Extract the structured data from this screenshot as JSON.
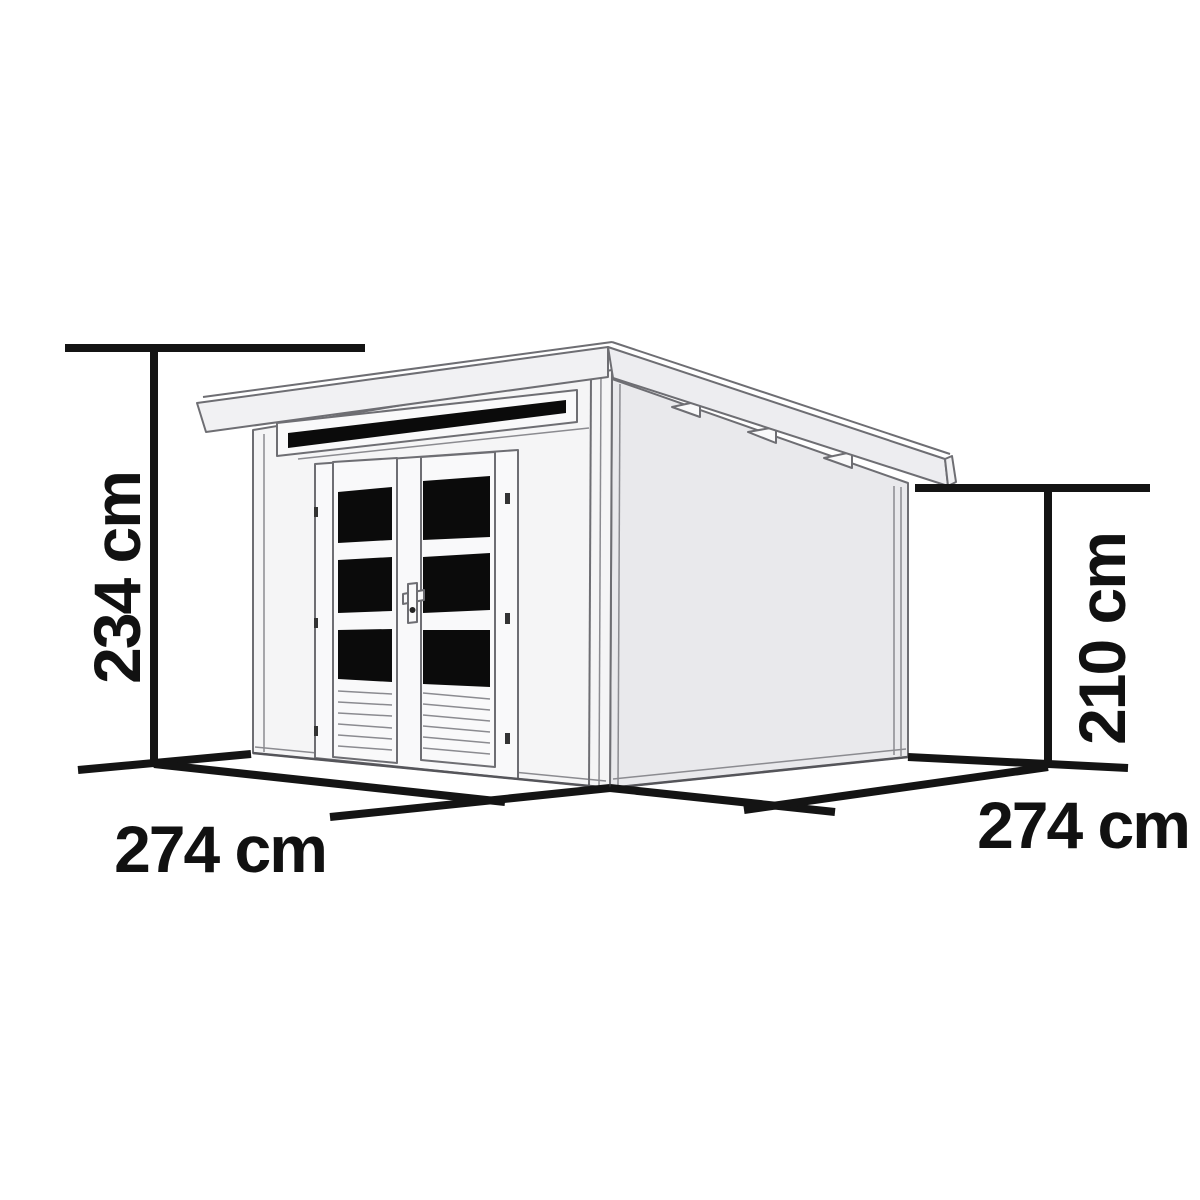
{
  "diagram": {
    "type": "isometric-dimension-drawing",
    "subject": "flat-roof garden shed with double doors, dark glazed door panels and a narrow transom window above the doors",
    "labels": {
      "height_left": "234 cm",
      "height_right": "210 cm",
      "width_front": "274 cm",
      "depth_side": "274 cm"
    },
    "dimensions": [
      {
        "id": "overall-height",
        "value": "234 cm",
        "orientation": "vertical",
        "position": "left"
      },
      {
        "id": "rear-wall-height",
        "value": "210 cm",
        "orientation": "vertical",
        "position": "right"
      },
      {
        "id": "front-width",
        "value": "274 cm",
        "orientation": "horizontal",
        "position": "bottom-left"
      },
      {
        "id": "side-depth",
        "value": "274 cm",
        "orientation": "horizontal",
        "position": "bottom-right"
      }
    ],
    "colors": {
      "background": "#ffffff",
      "dimension_line": "#141414",
      "dimension_text": "#111111",
      "shed_outline": "#6e6e73",
      "front_wall_fill": "#f5f5f6",
      "side_wall_fill": "#e9e9ec",
      "roof_fill": "#f1f1f3",
      "glass_fill": "#0b0b0b"
    }
  }
}
